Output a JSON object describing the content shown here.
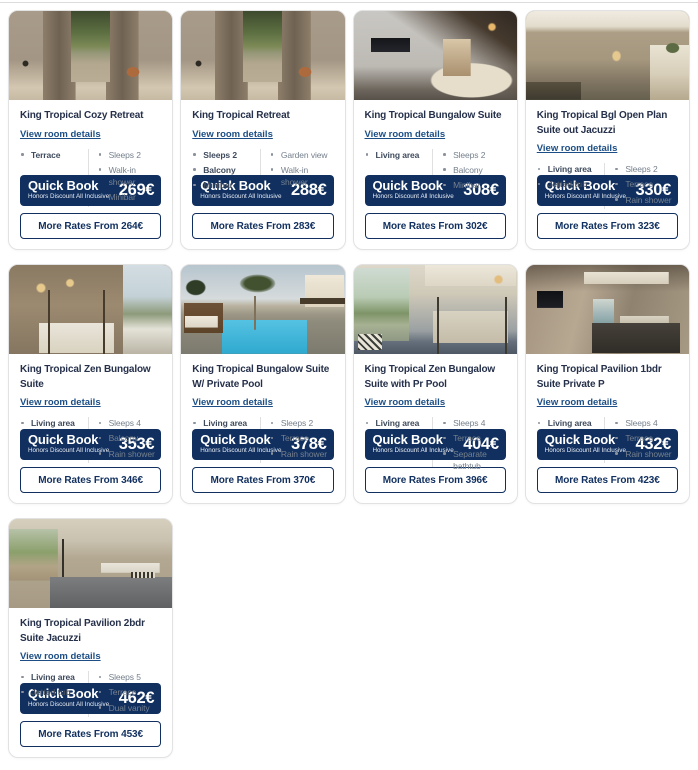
{
  "labels": {
    "view_room_details": "View room details",
    "quick_book": "Quick Book",
    "quick_book_subtitle": "Honors Discount All Inclusive"
  },
  "colors": {
    "primary_navy": "#11305f",
    "link_blue": "#1c4e85",
    "title_text": "#25304a",
    "feature_muted": "#76808d",
    "card_border": "#e2e2e2"
  },
  "rooms": [
    {
      "title": "King Tropical Cozy Retreat",
      "photo": "retreat",
      "features_left": [
        "Terrace"
      ],
      "features_right": [
        "Sleeps 2",
        "Walk-in shower",
        "Minibar"
      ],
      "quick_book_price": "269€",
      "more_rates_label": "More Rates From 264€"
    },
    {
      "title": "King Tropical Retreat",
      "photo": "retreat",
      "features_left": [
        "Sleeps 2",
        "Balcony",
        "Minibar"
      ],
      "features_right": [
        "Garden view",
        "Walk-in shower"
      ],
      "quick_book_price": "288€",
      "more_rates_label": "More Rates From 283€"
    },
    {
      "title": "King Tropical Bungalow Suite",
      "photo": "bungalow-living",
      "features_left": [
        "Living area"
      ],
      "features_right": [
        "Sleeps 2",
        "Balcony",
        "Minibar"
      ],
      "quick_book_price": "308€",
      "more_rates_label": "More Rates From 302€"
    },
    {
      "title": "King Tropical Bgl Open Plan Suite out Jacuzzi",
      "photo": "open-plan",
      "features_left": [
        "Living area",
        "Jetted tub"
      ],
      "features_right": [
        "Sleeps 2",
        "Terrace",
        "Rain shower"
      ],
      "quick_book_price": "330€",
      "more_rates_label": "More Rates From 323€"
    },
    {
      "title": "King Tropical Zen Bungalow Suite",
      "photo": "zen-balcony",
      "features_left": [
        "Living area"
      ],
      "features_right": [
        "Sleeps 4",
        "Balcony",
        "Rain shower"
      ],
      "quick_book_price": "353€",
      "more_rates_label": "More Rates From 346€"
    },
    {
      "title": "King Tropical Bungalow Suite W/ Private Pool",
      "photo": "private-pool",
      "features_left": [
        "Living area"
      ],
      "features_right": [
        "Sleeps 2",
        "Terrace",
        "Rain shower"
      ],
      "quick_book_price": "378€",
      "more_rates_label": "More Rates From 370€"
    },
    {
      "title": "King Tropical Zen Bungalow Suite with Pr Pool",
      "photo": "zen-garden",
      "features_left": [
        "Living area"
      ],
      "features_right": [
        "Sleeps 4",
        "Terrace",
        "Separate bathtub"
      ],
      "quick_book_price": "404€",
      "more_rates_label": "More Rates From 396€"
    },
    {
      "title": "King Tropical Pavilion 1bdr Suite Private P",
      "photo": "pavilion-1bdr",
      "features_left": [
        "Living area"
      ],
      "features_right": [
        "Sleeps 4",
        "Terrace",
        "Rain shower"
      ],
      "quick_book_price": "432€",
      "more_rates_label": "More Rates From 423€"
    },
    {
      "title": "King Tropical Pavilion 2bdr Suite Jacuzzi",
      "photo": "pavilion-2bdr",
      "features_left": [
        "Living area",
        "Jetted tub"
      ],
      "features_right": [
        "Sleeps 5",
        "Terrace",
        "Dual vanity"
      ],
      "quick_book_price": "462€",
      "more_rates_label": "More Rates From 453€"
    }
  ]
}
